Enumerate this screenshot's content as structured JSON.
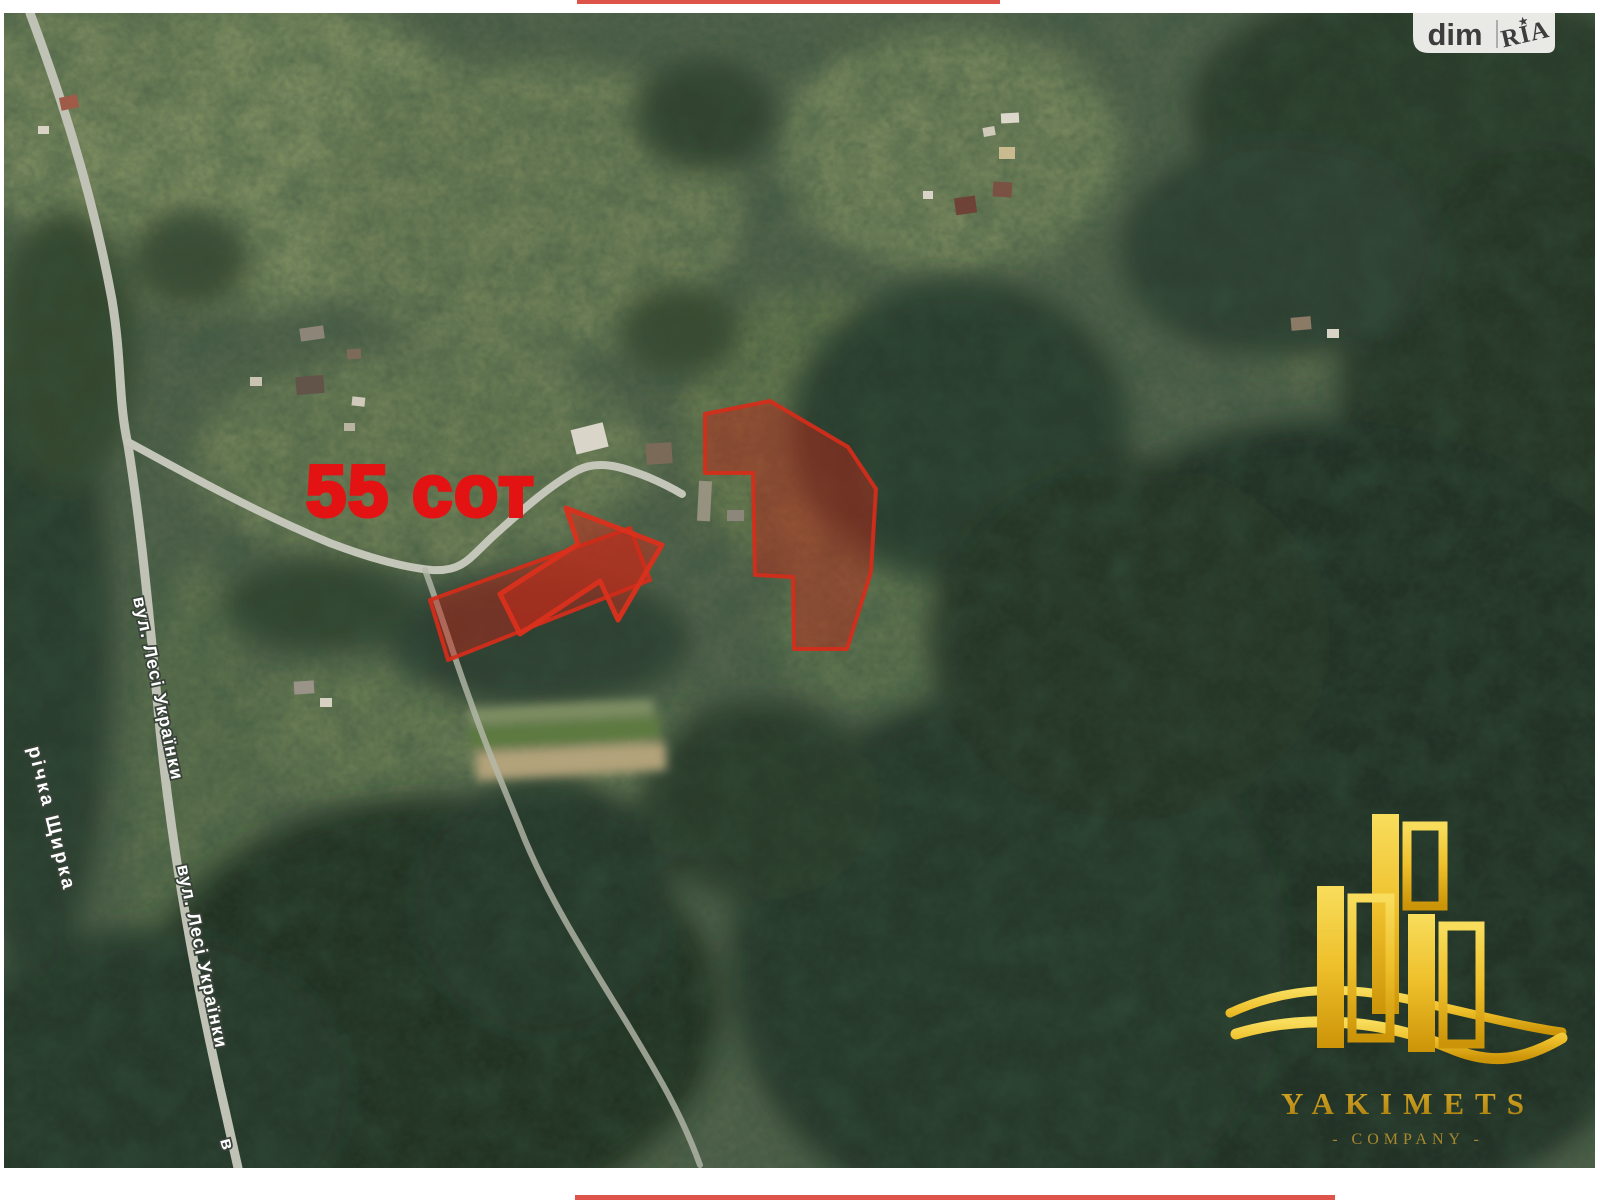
{
  "watermark": {
    "site_label": "dim",
    "brand_label": "RIA",
    "star_icon": "★"
  },
  "annotations": {
    "area_text": "55 сот",
    "street_name": "вул. Лесі Українки",
    "street_name_partial": "в",
    "river_name": "річка Щирка"
  },
  "company_logo": {
    "name": "YAKIMETS",
    "subtitle": "- COMPANY -"
  },
  "colors": {
    "overlay_red_fill": "rgba(198,36,22,0.45)",
    "overlay_red_stroke": "rgba(214,44,26,0.92)",
    "area_text_red": "#e41313",
    "edge_line_red": "#d8352a",
    "logo_gold": "#c08c15",
    "road_gray": "#c0c3b6",
    "badge_bg": "#e9e9e6",
    "badge_text": "#3d3d3d",
    "label_white": "#ffffff"
  }
}
